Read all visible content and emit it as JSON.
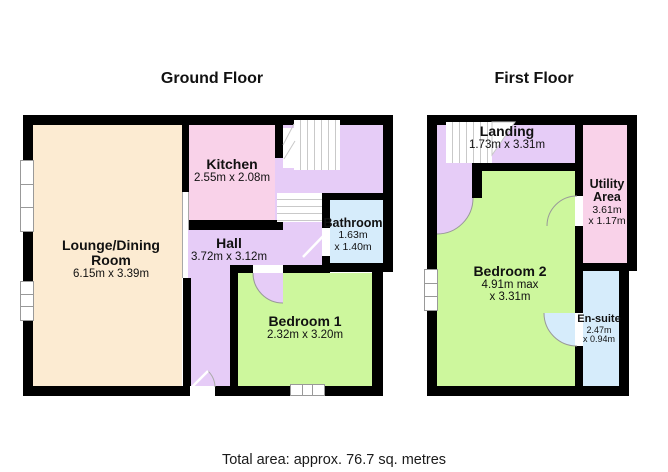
{
  "titles": {
    "ground": "Ground Floor",
    "first": "First Floor"
  },
  "footer": {
    "total_area": "Total area: approx. 76.7 sq. metres"
  },
  "colors": {
    "wall": "#000000",
    "lounge": "#fcebd2",
    "kitchen": "#f9d2e9",
    "hall": "#e6ccf7",
    "bedroom": "#cdf79d",
    "bathroom": "#d6ecfb",
    "utility": "#f9d2e9",
    "ensuite": "#d6ecfb",
    "landing": "#e6ccf7",
    "stairs": "#ffffff"
  },
  "ground_floor": {
    "title": "Ground Floor",
    "lounge": {
      "line1": "Lounge/Dining",
      "line2": "Room",
      "dims": "6.15m x 3.39m"
    },
    "kitchen": {
      "name": "Kitchen",
      "dims": "2.55m x 2.08m"
    },
    "hall": {
      "name": "Hall",
      "dims": "3.72m x 3.12m"
    },
    "bathroom": {
      "name": "Bathroom",
      "dims1": "1.63m",
      "dims2": "x 1.40m"
    },
    "bedroom1": {
      "name": "Bedroom 1",
      "dims": "2.32m x 3.20m"
    }
  },
  "first_floor": {
    "title": "First Floor",
    "landing": {
      "name": "Landing",
      "dims": "1.73m x 3.31m"
    },
    "utility": {
      "line1": "Utility",
      "line2": "Area",
      "dims1": "3.61m",
      "dims2": "x 1.17m"
    },
    "bedroom2": {
      "name": "Bedroom 2",
      "dims1": "4.91m max",
      "dims2": "x 3.31m"
    },
    "ensuite": {
      "name": "En-suite",
      "dims1": "2.47m",
      "dims2": "x 0.94m"
    }
  }
}
